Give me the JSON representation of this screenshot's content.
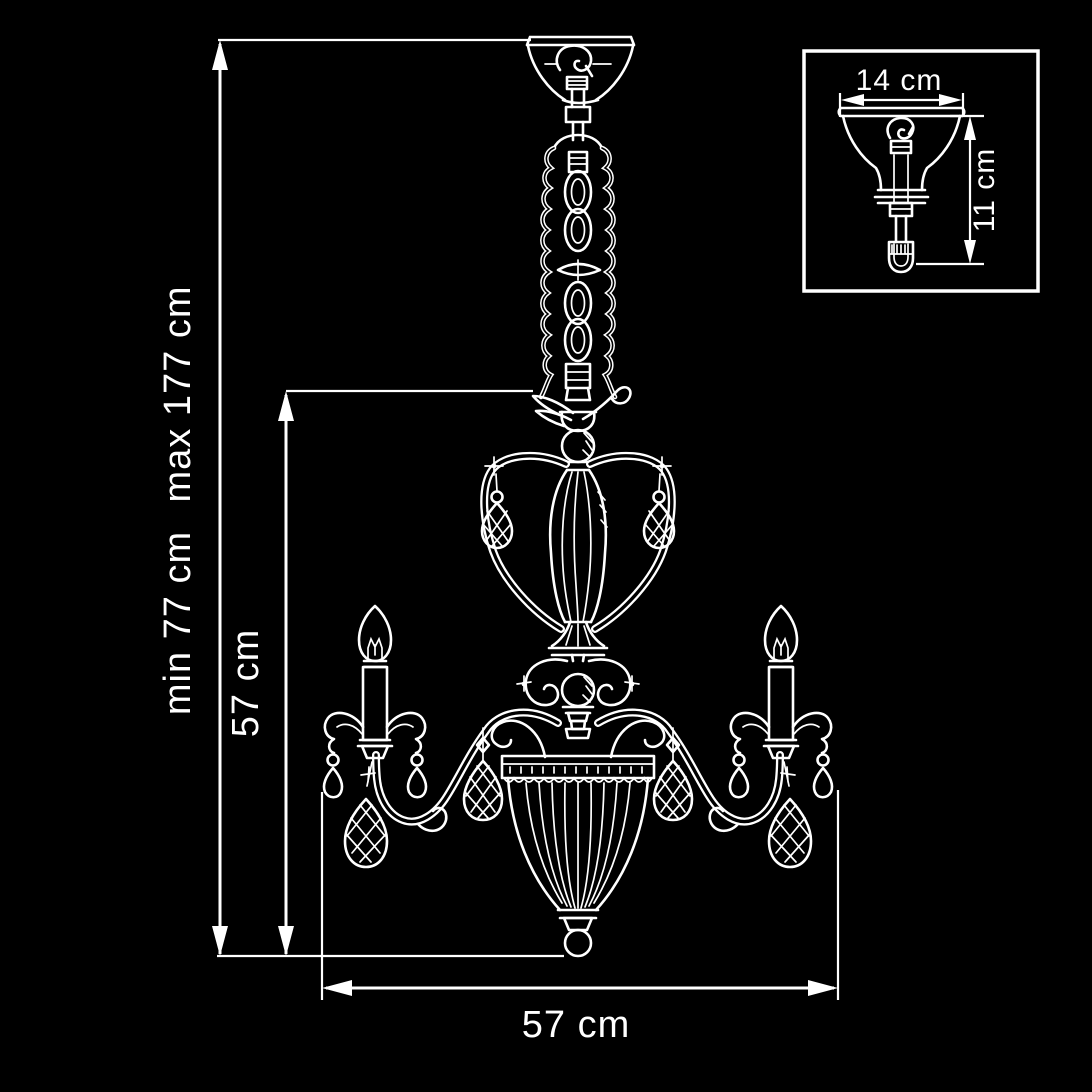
{
  "page": {
    "background_color": "#000000",
    "line_color": "#ffffff"
  },
  "dimensions": {
    "overall_height": {
      "min_label": "min 77 cm",
      "max_label": "max 177 cm"
    },
    "body_height_label": "57 cm",
    "width_label": "57 cm"
  },
  "inset": {
    "canopy_width_label": "14 cm",
    "canopy_height_label": "11 cm"
  }
}
